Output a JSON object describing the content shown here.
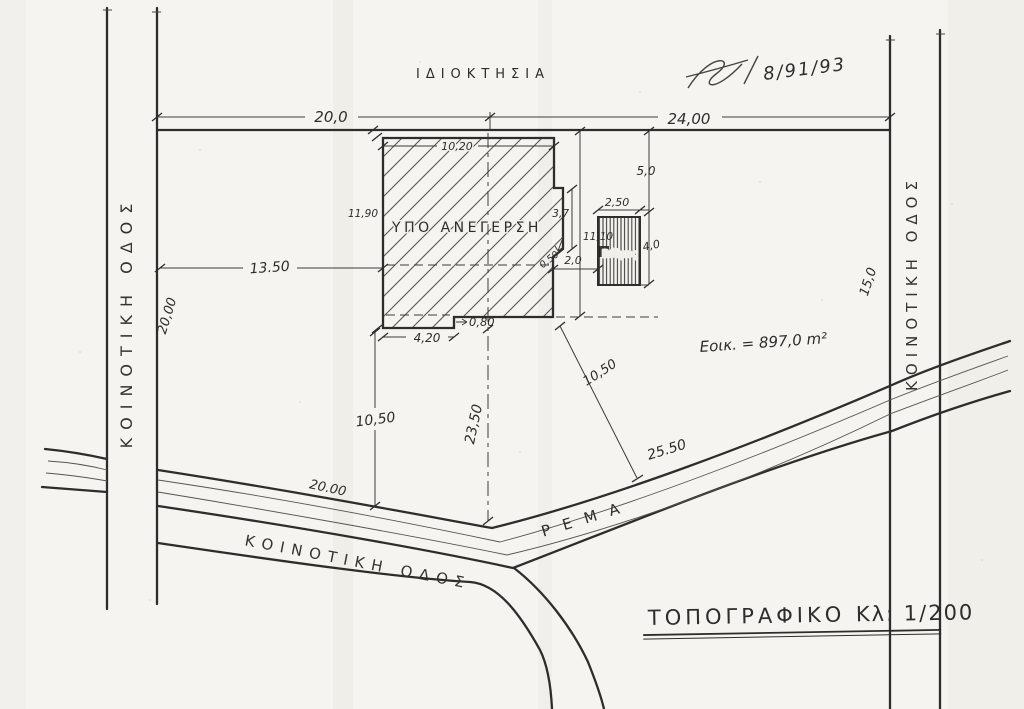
{
  "labels": {
    "property": "ΙΔΙΟΚΤΗΣΙΑ",
    "date": "8/91/93",
    "building": "ΥΠΟ ΑΝΕΓΕΡΣΗ",
    "cesspool": "Βόθρος",
    "stream": "ΡΕΜΑ",
    "road_left": "ΚΟΙΝΟΤΙΚΗ ΟΔΟΣ",
    "road_right": "ΚΟΙΝΟΤΙΚΗ ΟΔΟΣ",
    "road_bottom": "ΚΟΙΝΟΤΙΚΗ ΟΔΟΣ",
    "area_note": "Εοικ. = 897,0 m²",
    "title": "ΤΟΠΟΓΡΑΦΙΚΟ",
    "scale": "Κλ: 1/200"
  },
  "dims": {
    "top_left_frontage": "20,0",
    "top_right_frontage": "24,00",
    "building_width_top": "10,20",
    "building_height_left": "11,90",
    "notch_height": "3,7",
    "right_span": "11,10",
    "step_right": "0,50",
    "gap_to_cesspool": "2,0",
    "cesspool_width": "2,50",
    "cesspool_height": "4,0",
    "cesspool_offset_top": "5,0",
    "bottom_step": "0,80",
    "bottom_left_width": "4,20",
    "setback_left": "13.50",
    "side_left": "20,00",
    "side_right": "15,0",
    "setback_south": "10,50",
    "centerline_south": "23,50",
    "diagonal_to_stream": "10,50",
    "stream_frontage": "25.50",
    "boundary_south": "20.00"
  }
}
